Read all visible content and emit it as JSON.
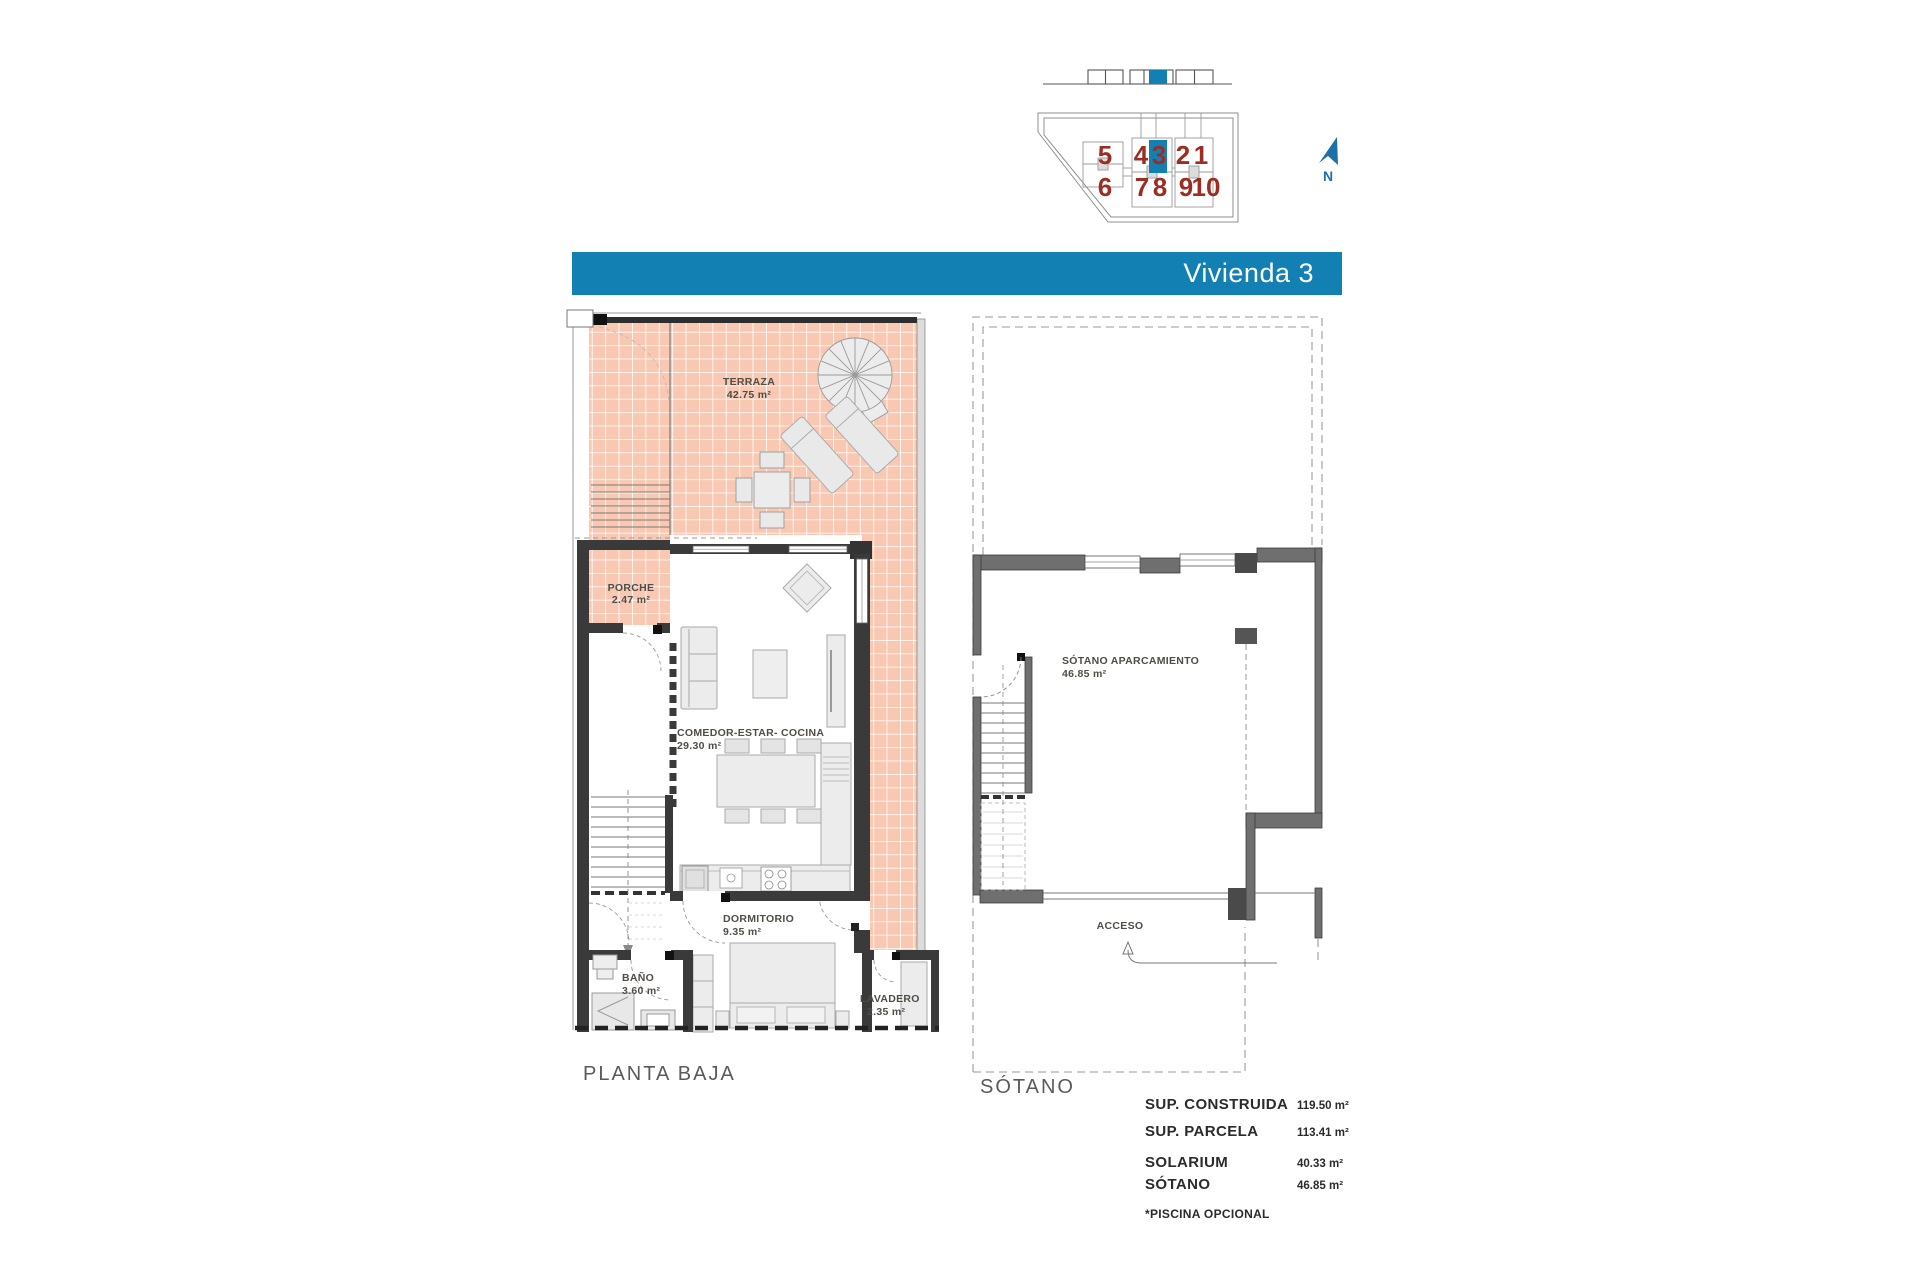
{
  "banner": {
    "title": "Vivienda 3"
  },
  "colors": {
    "accent_blue": "#1380b4",
    "unit_number_red": "#9b2d23",
    "tile_pink": "#f8c8b2",
    "wall_dark": "#3a3a3a",
    "wall_basement": "#6f6f6f"
  },
  "site_plan": {
    "units": [
      "5",
      "4",
      "3",
      "2",
      "1",
      "6",
      "7",
      "8",
      "9",
      "10"
    ],
    "highlighted_unit": "3",
    "north_label": "N"
  },
  "planta_baja": {
    "title": "PLANTA BAJA",
    "rooms": {
      "terraza": {
        "name": "TERRAZA",
        "area": "42.75 m²"
      },
      "porche": {
        "name": "PORCHE",
        "area": "2.47 m²"
      },
      "comedor": {
        "name": "COMEDOR-ESTAR- COCINA",
        "area": "29.30 m²"
      },
      "dormitorio": {
        "name": "DORMITORIO",
        "area": "9.35 m²"
      },
      "bano": {
        "name": "BAÑO",
        "area": "3.60 m²"
      },
      "lavadero": {
        "name": "LAVADERO",
        "area": "2.35 m²"
      }
    }
  },
  "sotano": {
    "title": "SÓTANO",
    "rooms": {
      "aparcamiento": {
        "name": "SÓTANO APARCAMIENTO",
        "area": "46.85 m²"
      }
    },
    "acceso_label": "ACCESO"
  },
  "summary": {
    "rows": [
      {
        "label": "SUP. CONSTRUIDA",
        "value": "119.50 m²"
      },
      {
        "label": "SUP. PARCELA",
        "value": "113.41 m²"
      },
      {
        "label": "SOLARIUM",
        "value": "40.33 m²"
      },
      {
        "label": "SÓTANO",
        "value": "46.85 m²"
      }
    ],
    "note": "*PISCINA OPCIONAL"
  }
}
